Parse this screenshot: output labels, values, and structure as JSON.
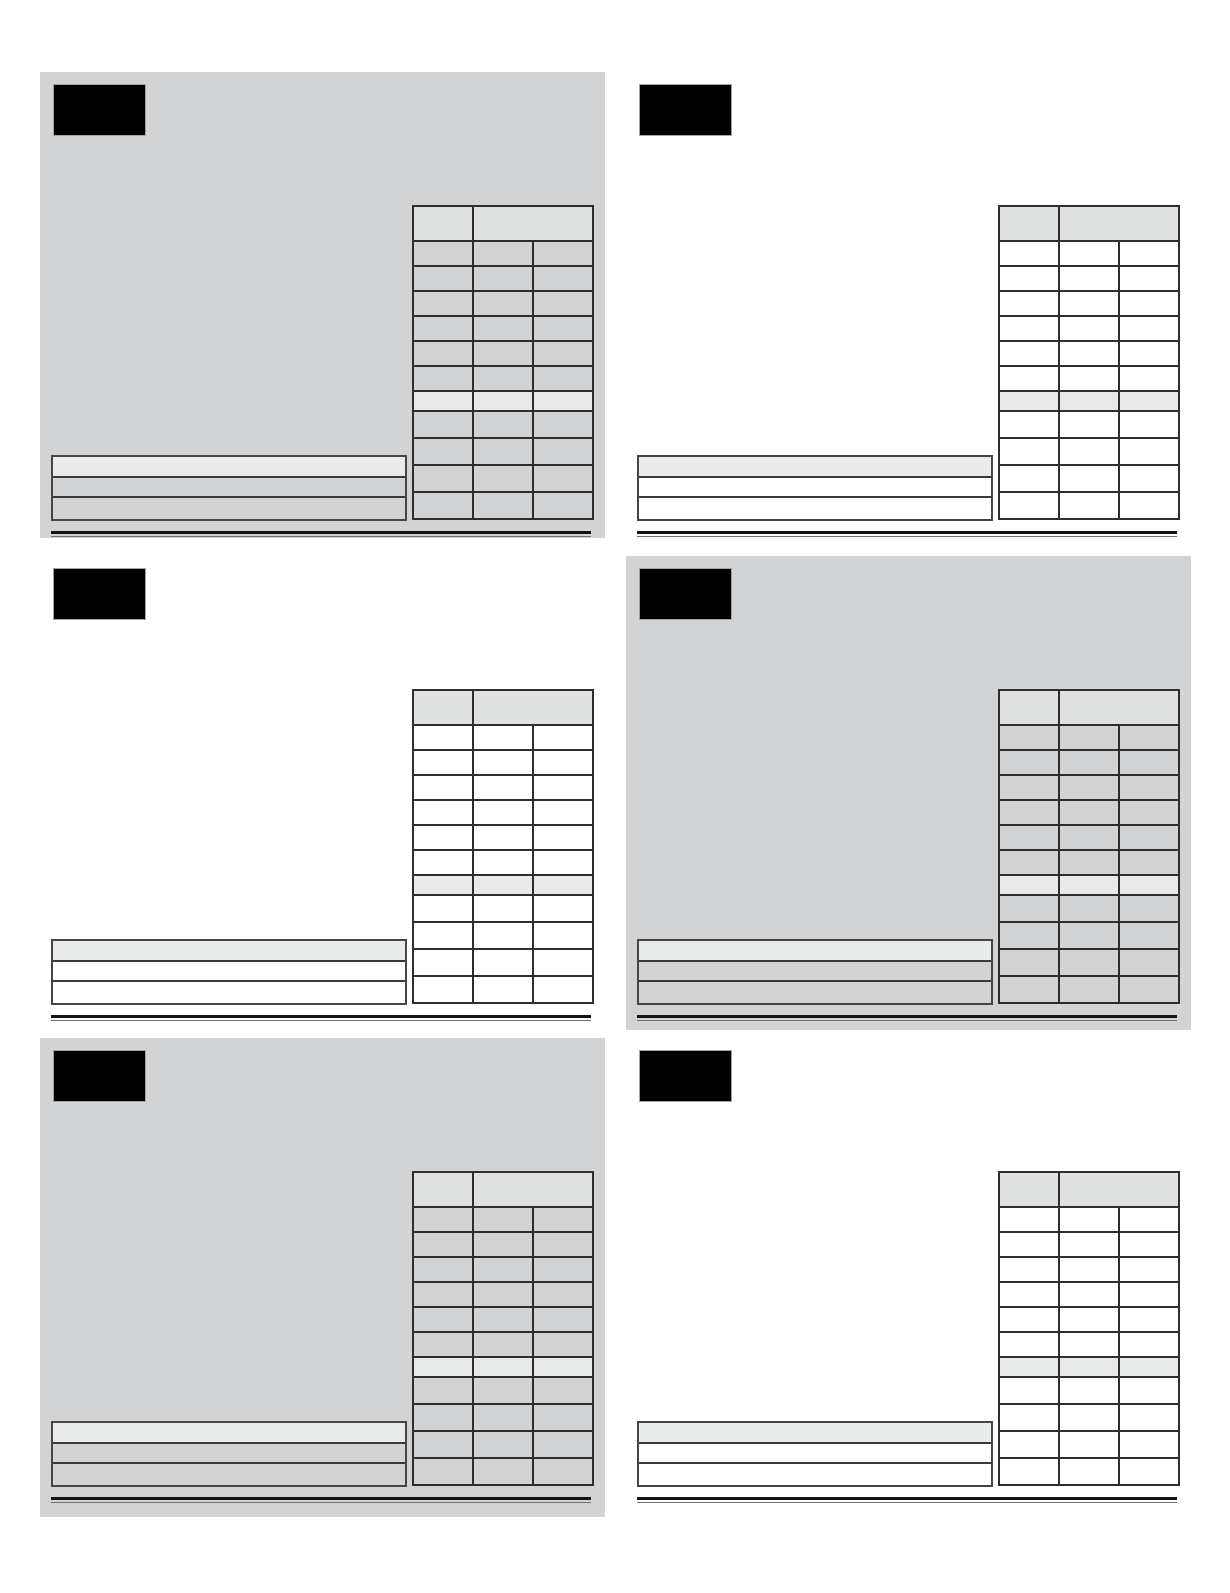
{
  "page": {
    "background": "#ffffff",
    "description": "Sheet of six blank redacted card templates, no visible text"
  },
  "colors": {
    "panel_gray": "#d2d3d4",
    "table_header_fill": "#dfe0e0",
    "highlight_row_fill": "#e9eaea",
    "bar_highlight_fill": "#e9eaea",
    "border_dark": "#2e2e2e",
    "redaction_black": "#000000",
    "rule_black": "#141414"
  },
  "cards": [
    {
      "id": "card-panel-1",
      "row": 1,
      "column": "left",
      "background": "gray"
    },
    {
      "id": "card-panel-2",
      "row": 1,
      "column": "right",
      "background": "white"
    },
    {
      "id": "card-panel-3",
      "row": 2,
      "column": "left",
      "background": "white"
    },
    {
      "id": "card-panel-4",
      "row": 2,
      "column": "right",
      "background": "gray"
    },
    {
      "id": "card-panel-5",
      "row": 3,
      "column": "left",
      "background": "gray"
    },
    {
      "id": "card-panel-6",
      "row": 3,
      "column": "right",
      "background": "white"
    }
  ],
  "card_template": {
    "redacted_label_text": "",
    "table": {
      "columns": 3,
      "header_cells": [
        "",
        ""
      ],
      "header_right_cell_spans_columns": 2,
      "body_row_count": 11,
      "highlight_row_index": 7,
      "cell_text": ""
    },
    "bottom_bars": {
      "row_count": 3,
      "highlight_row_index": 1,
      "row_text": ""
    },
    "has_bottom_rule": true
  }
}
